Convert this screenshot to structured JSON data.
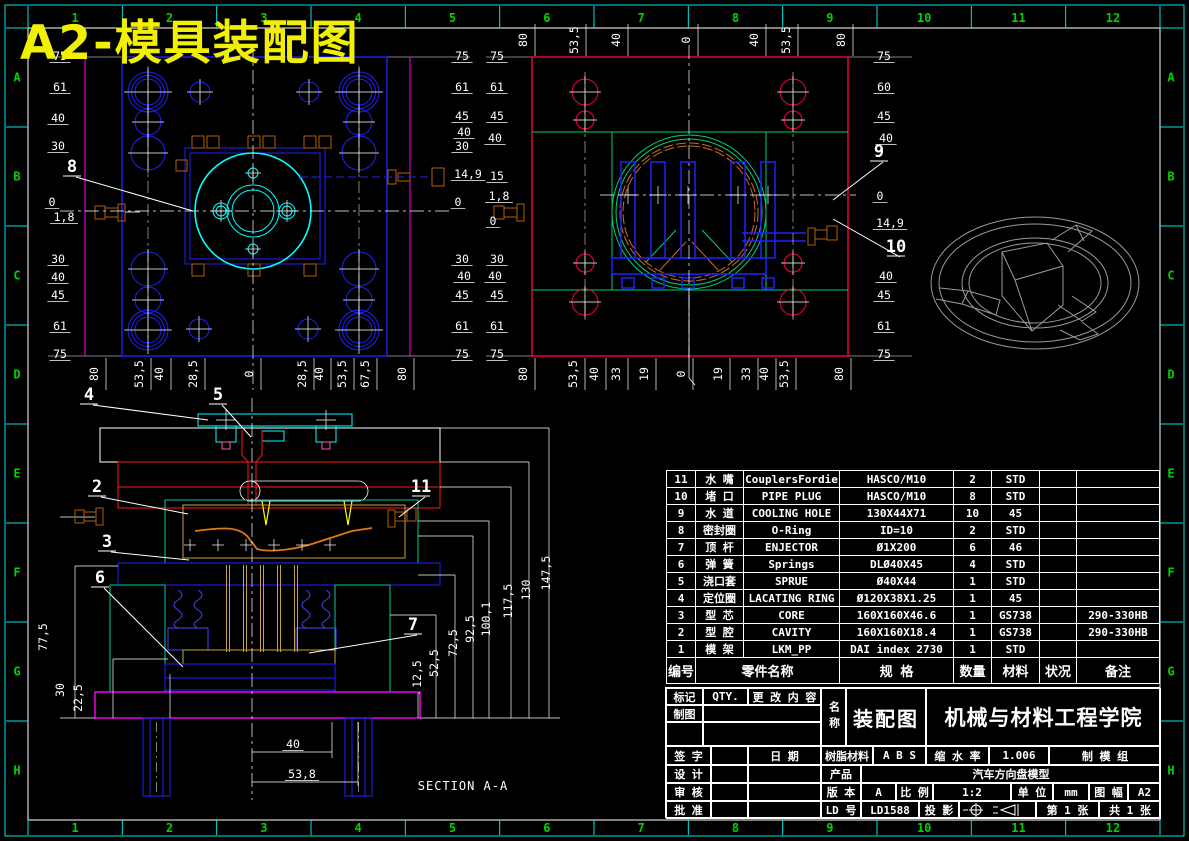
{
  "sheet": {
    "title": "A2-模具装配图"
  },
  "colors": {
    "background": "#000000",
    "frame": "#00e5e5",
    "zone_text": "#00d200",
    "title": "#f0f000",
    "dim_text": "#ffffff",
    "blue": "#2020ff",
    "cyan": "#00ffff",
    "crimson": "#ff0040",
    "green": "#00d070",
    "orange": "#c87828",
    "tan": "#c8a040",
    "magenta": "#ff00ff",
    "red": "#ff1a1a",
    "yellow": "#ffff00",
    "gray": "#9a9a9a"
  },
  "zones": {
    "cols": [
      "1",
      "2",
      "3",
      "4",
      "5",
      "6",
      "7",
      "8",
      "9",
      "10",
      "11",
      "12"
    ],
    "rows": [
      "A",
      "B",
      "C",
      "D",
      "E",
      "F",
      "G",
      "H"
    ]
  },
  "section_title": "SECTION A-A",
  "dim_labels": [
    {
      "t": "75",
      "x": 60,
      "y": 60
    },
    {
      "t": "61",
      "x": 60,
      "y": 91
    },
    {
      "t": "40",
      "x": 58,
      "y": 122
    },
    {
      "t": "30",
      "x": 58,
      "y": 150
    },
    {
      "t": "0",
      "x": 52,
      "y": 206
    },
    {
      "t": "1,8",
      "x": 64,
      "y": 221
    },
    {
      "t": "30",
      "x": 58,
      "y": 263
    },
    {
      "t": "40",
      "x": 58,
      "y": 281
    },
    {
      "t": "45",
      "x": 58,
      "y": 299
    },
    {
      "t": "61",
      "x": 60,
      "y": 330
    },
    {
      "t": "75",
      "x": 60,
      "y": 358
    },
    {
      "t": "75",
      "x": 462,
      "y": 60
    },
    {
      "t": "61",
      "x": 462,
      "y": 91
    },
    {
      "t": "45",
      "x": 462,
      "y": 120
    },
    {
      "t": "40",
      "x": 464,
      "y": 136
    },
    {
      "t": "30",
      "x": 462,
      "y": 150
    },
    {
      "t": "14,9",
      "x": 468,
      "y": 178
    },
    {
      "t": "0",
      "x": 458,
      "y": 206
    },
    {
      "t": "30",
      "x": 462,
      "y": 263
    },
    {
      "t": "40",
      "x": 464,
      "y": 280
    },
    {
      "t": "45",
      "x": 462,
      "y": 299
    },
    {
      "t": "61",
      "x": 462,
      "y": 330
    },
    {
      "t": "75",
      "x": 462,
      "y": 358
    },
    {
      "t": "80",
      "x": 98,
      "y": 374,
      "r": 1
    },
    {
      "t": "53,5",
      "x": 143,
      "y": 374,
      "r": 1
    },
    {
      "t": "40",
      "x": 163,
      "y": 374,
      "r": 1
    },
    {
      "t": "28,5",
      "x": 197,
      "y": 374,
      "r": 1
    },
    {
      "t": "0",
      "x": 253,
      "y": 374,
      "r": 1
    },
    {
      "t": "28,5",
      "x": 306,
      "y": 374,
      "r": 1
    },
    {
      "t": "40",
      "x": 323,
      "y": 374,
      "r": 1
    },
    {
      "t": "53,5",
      "x": 346,
      "y": 374,
      "r": 1
    },
    {
      "t": "67,5",
      "x": 369,
      "y": 374,
      "r": 1
    },
    {
      "t": "80",
      "x": 406,
      "y": 374,
      "r": 1
    },
    {
      "t": "80",
      "x": 527,
      "y": 40,
      "r": 1
    },
    {
      "t": "53,5",
      "x": 578,
      "y": 40,
      "r": 1
    },
    {
      "t": "40",
      "x": 620,
      "y": 40,
      "r": 1
    },
    {
      "t": "0",
      "x": 690,
      "y": 40,
      "r": 1
    },
    {
      "t": "40",
      "x": 758,
      "y": 40,
      "r": 1
    },
    {
      "t": "53,5",
      "x": 790,
      "y": 40,
      "r": 1
    },
    {
      "t": "80",
      "x": 845,
      "y": 40,
      "r": 1
    },
    {
      "t": "75",
      "x": 497,
      "y": 60
    },
    {
      "t": "61",
      "x": 497,
      "y": 91
    },
    {
      "t": "45",
      "x": 497,
      "y": 120
    },
    {
      "t": "40",
      "x": 495,
      "y": 142
    },
    {
      "t": "15",
      "x": 497,
      "y": 180
    },
    {
      "t": "1,8",
      "x": 499,
      "y": 200
    },
    {
      "t": "0",
      "x": 493,
      "y": 225
    },
    {
      "t": "30",
      "x": 497,
      "y": 263
    },
    {
      "t": "40",
      "x": 495,
      "y": 280
    },
    {
      "t": "45",
      "x": 497,
      "y": 299
    },
    {
      "t": "61",
      "x": 497,
      "y": 330
    },
    {
      "t": "75",
      "x": 497,
      "y": 358
    },
    {
      "t": "75",
      "x": 884,
      "y": 60
    },
    {
      "t": "60",
      "x": 884,
      "y": 91
    },
    {
      "t": "45",
      "x": 884,
      "y": 120
    },
    {
      "t": "40",
      "x": 886,
      "y": 142
    },
    {
      "t": "0",
      "x": 880,
      "y": 200
    },
    {
      "t": "14,9",
      "x": 890,
      "y": 227
    },
    {
      "t": "40",
      "x": 886,
      "y": 280
    },
    {
      "t": "45",
      "x": 884,
      "y": 299
    },
    {
      "t": "61",
      "x": 884,
      "y": 330
    },
    {
      "t": "75",
      "x": 884,
      "y": 358
    },
    {
      "t": "80",
      "x": 527,
      "y": 374,
      "r": 1
    },
    {
      "t": "53,5",
      "x": 577,
      "y": 374,
      "r": 1
    },
    {
      "t": "40",
      "x": 598,
      "y": 374,
      "r": 1
    },
    {
      "t": "33",
      "x": 620,
      "y": 374,
      "r": 1
    },
    {
      "t": "19",
      "x": 648,
      "y": 374,
      "r": 1
    },
    {
      "t": "0",
      "x": 685,
      "y": 374,
      "r": 1
    },
    {
      "t": "19",
      "x": 722,
      "y": 374,
      "r": 1
    },
    {
      "t": "33",
      "x": 750,
      "y": 374,
      "r": 1
    },
    {
      "t": "40",
      "x": 768,
      "y": 374,
      "r": 1
    },
    {
      "t": "53,5",
      "x": 788,
      "y": 374,
      "r": 1
    },
    {
      "t": "80",
      "x": 843,
      "y": 374,
      "r": 1
    },
    {
      "t": "77,5",
      "x": 47,
      "y": 637,
      "r": 1,
      "nl": 1
    },
    {
      "t": "30",
      "x": 64,
      "y": 690,
      "r": 1,
      "nl": 1
    },
    {
      "t": "22,5",
      "x": 82,
      "y": 698,
      "r": 1,
      "nl": 1
    },
    {
      "t": "12,5",
      "x": 421,
      "y": 674,
      "r": 1,
      "nl": 1
    },
    {
      "t": "52,5",
      "x": 438,
      "y": 663,
      "r": 1,
      "nl": 1
    },
    {
      "t": "72,5",
      "x": 457,
      "y": 643,
      "r": 1,
      "nl": 1
    },
    {
      "t": "92,5",
      "x": 474,
      "y": 629,
      "r": 1,
      "nl": 1
    },
    {
      "t": "100,1",
      "x": 490,
      "y": 619,
      "r": 1,
      "nl": 1
    },
    {
      "t": "117,5",
      "x": 512,
      "y": 601,
      "r": 1,
      "nl": 1
    },
    {
      "t": "130",
      "x": 530,
      "y": 590,
      "r": 1,
      "nl": 1
    },
    {
      "t": "147,5",
      "x": 550,
      "y": 573,
      "r": 1,
      "nl": 1
    },
    {
      "t": "40",
      "x": 293,
      "y": 748
    },
    {
      "t": "53,8",
      "x": 302,
      "y": 778
    }
  ],
  "balloons": [
    {
      "n": "8",
      "x": 72,
      "y": 172,
      "tx": 193,
      "ty": 211
    },
    {
      "n": "9",
      "x": 879,
      "y": 157,
      "tx": 833,
      "ty": 200
    },
    {
      "n": "10",
      "x": 896,
      "y": 252,
      "tx": 833,
      "ty": 219
    },
    {
      "n": "4",
      "x": 89,
      "y": 400,
      "tx": 208,
      "ty": 420
    },
    {
      "n": "5",
      "x": 218,
      "y": 400,
      "tx": 251,
      "ty": 437
    },
    {
      "n": "2",
      "x": 97,
      "y": 492,
      "tx": 188,
      "ty": 514
    },
    {
      "n": "11",
      "x": 421,
      "y": 492,
      "tx": 399,
      "ty": 517
    },
    {
      "n": "3",
      "x": 107,
      "y": 547,
      "tx": 189,
      "ty": 560
    },
    {
      "n": "6",
      "x": 100,
      "y": 583,
      "tx": 183,
      "ty": 667
    },
    {
      "n": "7",
      "x": 413,
      "y": 630,
      "tx": 309,
      "ty": 653
    }
  ],
  "bom": {
    "headers": {
      "no": "编号",
      "name": "零件名称",
      "spec": "规 格",
      "qty": "数量",
      "material": "材料",
      "status": "状况",
      "remark": "备注"
    },
    "rows": [
      {
        "no": "11",
        "cn": "水  嘴",
        "en": "CouplersFordie",
        "spec": "HASCO/M10",
        "qty": "2",
        "mat": "STD",
        "status": "",
        "remark": ""
      },
      {
        "no": "10",
        "cn": "堵  口",
        "en": "PIPE PLUG",
        "spec": "HASCO/M10",
        "qty": "8",
        "mat": "STD",
        "status": "",
        "remark": ""
      },
      {
        "no": "9",
        "cn": "水  道",
        "en": "COOLING HOLE",
        "spec": "130X44X71",
        "qty": "10",
        "mat": "45",
        "status": "",
        "remark": ""
      },
      {
        "no": "8",
        "cn": "密封圈",
        "en": "O-Ring",
        "spec": "ID=10",
        "qty": "2",
        "mat": "STD",
        "status": "",
        "remark": ""
      },
      {
        "no": "7",
        "cn": "顶  杆",
        "en": "ENJECTOR",
        "spec": "Ø1X200",
        "qty": "6",
        "mat": "46",
        "status": "",
        "remark": ""
      },
      {
        "no": "6",
        "cn": "弹  簧",
        "en": "Springs",
        "spec": "DLØ40X45",
        "qty": "4",
        "mat": "STD",
        "status": "",
        "remark": ""
      },
      {
        "no": "5",
        "cn": "浇口套",
        "en": "SPRUE",
        "spec": "Ø40X44",
        "qty": "1",
        "mat": "STD",
        "status": "",
        "remark": ""
      },
      {
        "no": "4",
        "cn": "定位圈",
        "en": "LACATING RING",
        "spec": "Ø120X38X1.25",
        "qty": "1",
        "mat": "45",
        "status": "",
        "remark": ""
      },
      {
        "no": "3",
        "cn": "型  芯",
        "en": "CORE",
        "spec": "160X160X46.6",
        "qty": "1",
        "mat": "GS738",
        "status": "",
        "remark": "290-330HB"
      },
      {
        "no": "2",
        "cn": "型  腔",
        "en": "CAVITY",
        "spec": "160X160X18.4",
        "qty": "1",
        "mat": "GS738",
        "status": "",
        "remark": "290-330HB"
      },
      {
        "no": "1",
        "cn": "模  架",
        "en": "LKM_PP",
        "spec": "DAI index 2730",
        "qty": "1",
        "mat": "STD",
        "status": "",
        "remark": ""
      }
    ]
  },
  "title_block": {
    "mark_label": "标记",
    "qty_label": "QTY.",
    "change_label": "更 改 内 容",
    "draft_label": "制图",
    "name_label": "名称",
    "drawing_name": "装配图",
    "organization": "机械与材料工程学院",
    "sign_label": "签 字",
    "date_label": "日  期",
    "resin_label": "树脂材料",
    "resin_value": "A B S",
    "shrink_label": "缩 水 率",
    "shrink_value": "1.006",
    "group_label": "制 模 组",
    "design_label": "设 计",
    "product_label": "产品",
    "product_value": "汽车方向盘模型",
    "check_label": "审 核",
    "version_label": "版 本",
    "version_value": "A",
    "scale_label": "比 例",
    "scale_value": "1:2",
    "unit_label": "单 位",
    "unit_value": "mm",
    "format_label": "图 幅",
    "format_value": "A2",
    "approve_label": "批 准",
    "ld_label": "LD 号",
    "ld_value": "LD1588",
    "projection_label": "投 影",
    "sheet_number": "第 1  张",
    "sheet_total": "共 1  张"
  }
}
